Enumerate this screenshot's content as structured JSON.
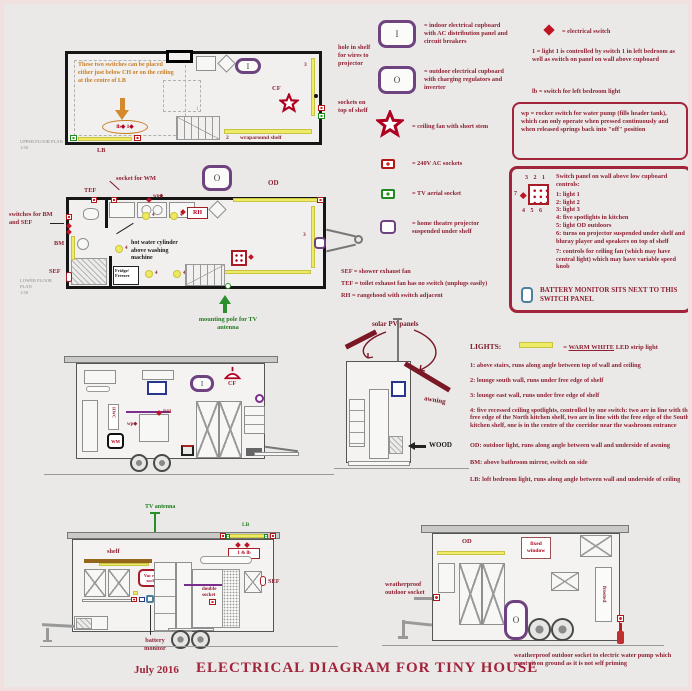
{
  "colors": {
    "dark_red": "#8e2133",
    "red": "#b3001d",
    "purple": "#6f4380",
    "yellow": "#eeeb66",
    "green": "#237a23",
    "orange": "#c87e26",
    "blue": "#27368f",
    "steel_blue": "#4a7fa0"
  },
  "title": {
    "date": "July 2016",
    "main": "ELECTRICAL DIAGRAM FOR TINY HOUSE"
  },
  "loft_plan": {
    "caption": "UPPER FLOOR PLAN",
    "scale": "1:50",
    "note_switches": "These two switches can be placed either just below CH or on the ceiling at the centre of LB",
    "oval": "lb◆ 1◆",
    "lb": "LB",
    "cf": "CF",
    "i": "I",
    "stair_num": "1",
    "strip3": "3",
    "shelf_num": "2",
    "shelf_text": "wraparound shelf",
    "hole_note": "hole in shelf for wires to projector",
    "sockets_note": "sockets on top of shelf"
  },
  "main_plan": {
    "caption": "LOWER FLOOR PLAN",
    "scale": "1:50",
    "tef": "TEF",
    "socket_wm": "socket for WM",
    "wp": "wp◆",
    "switches_bm_sef": "switches for BM and SEF",
    "bm": "BM",
    "sef": "SEF",
    "fridge": "Fridge/ Freezer",
    "rh": "RH",
    "o": "O",
    "od": "OD",
    "strip3": "3",
    "hwc_note": "hot water cylinder above washing machine",
    "antenna_note": "mounting pole for TV antenna",
    "lamp_nums": [
      "4",
      "4",
      "4",
      "4",
      "4"
    ]
  },
  "legend_left": {
    "i_sym": "I",
    "i_text": "= indoor electrical cupboard with AC distribution panel and circuit breakers",
    "o_sym": "O",
    "o_text": "= outdoor electrical cupboard with charging regulators and inverter",
    "fan_text": "= ceiling fan with short stem",
    "socket240_text": "= 240V AC sockets",
    "tv_text": "= TV aerial socket",
    "projector_text": "= home theatre projector suspended under shelf",
    "sef_def": "SEF = shower exhaust fan",
    "tef_def": "TEF = toilet exhaust fan has no switch (unplugs easily)",
    "rh_def": "RH = rangehood with switch adjacent"
  },
  "legend_right": {
    "switch_text": "= electrical switch",
    "note1": "1 = light 1 is controlled by switch 1 in left bedroom as well as switch on panel on wall above cupboard",
    "note_lb": "lb = switch for left bedroom light",
    "wp_note": "wp = rocker switch for water pump (fills header tank), which can only operate when pressed continuously and when released springs back into \"off\" position",
    "panel": {
      "top_nums": "3 2 1",
      "left_num": "7",
      "bottom_nums": "4 5 6",
      "heading": "Switch panel on wall above low cupboard controls:",
      "items": [
        "1: light 1",
        "2: light 2",
        "3: light 3",
        "4: five spotlights in kitchen",
        "5: light OD outdoors",
        "6: turns on projector suspended under shelf and bluray player and speakers on top of shelf",
        "7: controls for ceiling fan (which may have central light) which may have variable speed knob"
      ],
      "battery": "BATTERY MONITOR SITS NEXT TO THIS SWITCH PANEL"
    }
  },
  "side_elevation": {
    "i": "I",
    "cf": "CF",
    "rh": "RH",
    "wp": "wp◆",
    "wm": "WM",
    "hwc": "HWC"
  },
  "end_elevation": {
    "solar": "solar PV panels",
    "awning": "awning",
    "wood": "WOOD"
  },
  "lights_block": {
    "heading": "LIGHTS:",
    "label_eq": "=",
    "label_u": "WARM WHITE",
    "label_rest": "LED strip light",
    "items": [
      "1: above stairs, runs along angle between top of wall and ceiling",
      "2: lounge south wall, runs under free edge of shelf",
      "3: lounge east wall, runs under free edge of shelf",
      "4: five recessed ceiling spotlights, controlled by one switch: two are in line with the free edge of the North kitchen shelf, two are in line with the free edge of the South kitchen shelf, one is in the centre of the corridor near the washroom entrance",
      "OD: outdoor light, runs along angle between wall and underside of awning",
      "BM: above bathroom mirror, switch on side",
      "LB: loft bedroom light, runs along angle between wall and underside of ceiling"
    ]
  },
  "rear_elevation": {
    "tv_antenna": "TV antenna",
    "lb": "LB",
    "one_lb": "1 & lb",
    "shelf": "shelf",
    "vac": "Vac robo socket",
    "double_socket": "double socket",
    "sef": "SEF",
    "battery": "battery monitor"
  },
  "front_elevation": {
    "od": "OD",
    "fixed_window": "fixed window",
    "frosted": "frosted",
    "weatherproof": "weatherproof outdoor socket",
    "o": "O",
    "pump_note": "weatherproof outdoor socket to electric water pump which must sit on ground as it is not self priming"
  }
}
